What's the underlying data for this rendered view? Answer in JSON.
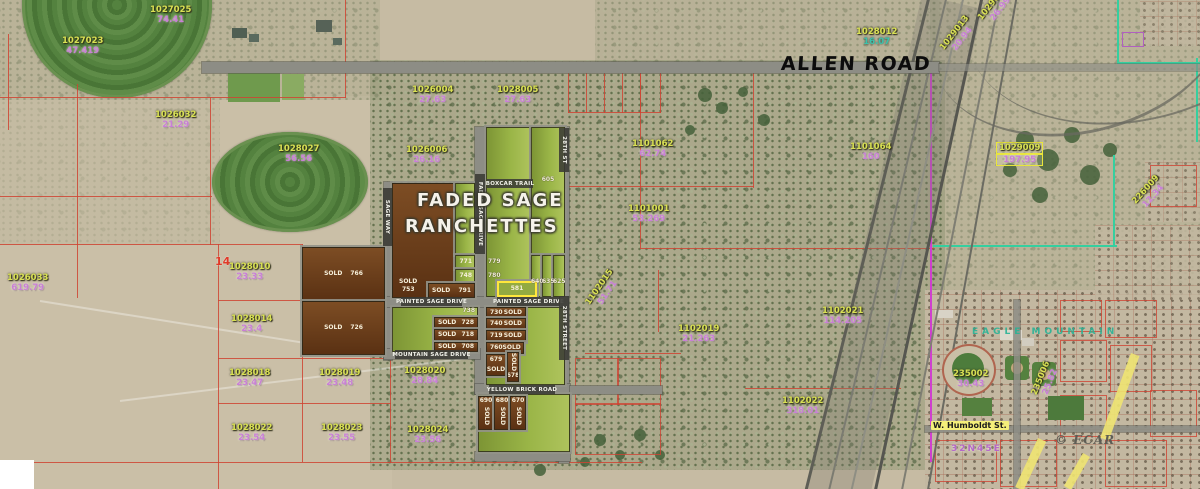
{
  "map": {
    "big_labels": {
      "allen_road": "ALLEN ROAD",
      "subdivision_line1": "FADED SAGE",
      "subdivision_line2": "RANCHETTES",
      "eagle_mountain": "EAGLE MOUNTAIN",
      "township": "32N45E",
      "humboldt_street": "W. Humboldt St.",
      "watermark": "© ECAR"
    },
    "streets": [
      {
        "t": "BOXCAR TRAIL",
        "x": 487,
        "y": 179,
        "w": 46,
        "h": 9,
        "v": 0
      },
      {
        "t": "PAINTED SAGE DRIVE",
        "x": 401,
        "y": 297,
        "w": 61,
        "h": 9,
        "v": 0
      },
      {
        "t": "PAINTED SAGE DRIVE",
        "x": 497,
        "y": 297,
        "w": 63,
        "h": 9,
        "v": 0
      },
      {
        "t": "MOUNTAIN SAGE DRIVE",
        "x": 395,
        "y": 350,
        "w": 73,
        "h": 9,
        "v": 0
      },
      {
        "t": "YELLOW BRICK ROAD",
        "x": 489,
        "y": 385,
        "w": 66,
        "h": 9,
        "v": 0
      },
      {
        "t": "28TH ST",
        "x": 559,
        "y": 128,
        "w": 10,
        "h": 44,
        "v": 1
      },
      {
        "t": "28TH STREET",
        "x": 559,
        "y": 296,
        "w": 10,
        "h": 64,
        "v": 1
      },
      {
        "t": "FADED SAGE DRIVE",
        "x": 475,
        "y": 174,
        "w": 10,
        "h": 80,
        "v": 1
      },
      {
        "t": "SAGE WAY",
        "x": 383,
        "y": 188,
        "w": 9,
        "h": 58,
        "v": 1
      }
    ],
    "parcels": [
      {
        "id": "1027023",
        "area": "47.419",
        "x": 62,
        "y": 36
      },
      {
        "id": "1027025",
        "area": "74.41",
        "x": 150,
        "y": 5
      },
      {
        "id": "1026032",
        "area": "21.29",
        "x": 155,
        "y": 110
      },
      {
        "id": "1028027",
        "area": "56.56",
        "x": 278,
        "y": 144
      },
      {
        "id": "1026004",
        "area": "27.63",
        "x": 412,
        "y": 85
      },
      {
        "id": "1028005",
        "area": "27.63",
        "x": 497,
        "y": 85
      },
      {
        "id": "1026006",
        "area": "26.16",
        "x": 406,
        "y": 145
      },
      {
        "id": "1028012",
        "area": "16.07",
        "x": 856,
        "y": 27,
        "style": "teal"
      },
      {
        "id": "1029013",
        "area": "20.94",
        "x": 938,
        "y": 26,
        "rot": -52
      },
      {
        "id": "1029012",
        "area": "26.99",
        "x": 976,
        "y": -4,
        "rot": -52
      },
      {
        "id": "1101062",
        "area": "62.74",
        "x": 632,
        "y": 139
      },
      {
        "id": "1101064",
        "area": "160",
        "x": 850,
        "y": 142
      },
      {
        "id": "1101001",
        "area": "53.269",
        "x": 628,
        "y": 204
      },
      {
        "id": "1029009",
        "area": "197.95",
        "x": 996,
        "y": 142,
        "style": "boxed"
      },
      {
        "id": "226009",
        "area": "12.34",
        "x": 1132,
        "y": 183,
        "rot": -48
      },
      {
        "id": "1102015",
        "area": "51.71",
        "x": 583,
        "y": 280,
        "rot": -55
      },
      {
        "id": "1102019",
        "area": "21.263",
        "x": 678,
        "y": 324
      },
      {
        "id": "1102021",
        "area": "114.205",
        "x": 822,
        "y": 306
      },
      {
        "id": "1102022",
        "area": "318.01",
        "x": 782,
        "y": 396
      },
      {
        "id": "1028020",
        "area": "28.84",
        "x": 404,
        "y": 366
      },
      {
        "id": "1026033",
        "area": "619.79",
        "x": 7,
        "y": 273
      },
      {
        "id": "14",
        "area": "",
        "x": 215,
        "y": 255,
        "style": "red"
      },
      {
        "id": "1028010",
        "area": "23.33",
        "x": 229,
        "y": 262
      },
      {
        "id": "1028014",
        "area": "23.4",
        "x": 231,
        "y": 314
      },
      {
        "id": "1028018",
        "area": "23.47",
        "x": 229,
        "y": 368
      },
      {
        "id": "1028019",
        "area": "23.48",
        "x": 319,
        "y": 368
      },
      {
        "id": "1028022",
        "area": "23.54",
        "x": 231,
        "y": 423
      },
      {
        "id": "1028023",
        "area": "23.55",
        "x": 321,
        "y": 423
      },
      {
        "id": "1028024",
        "area": "23.56",
        "x": 407,
        "y": 425
      },
      {
        "id": "235002",
        "area": "30.43",
        "x": 953,
        "y": 369
      },
      {
        "id": "235006",
        "area": "25.82",
        "x": 1028,
        "y": 370,
        "rot": -68
      }
    ],
    "lots": [
      {
        "x": 392,
        "y": 183,
        "w": 63,
        "h": 115,
        "c": "b",
        "t1": "SOLD",
        "t2": "753",
        "a": "bl"
      },
      {
        "x": 455,
        "y": 183,
        "w": 20,
        "h": 72,
        "c": "g"
      },
      {
        "x": 455,
        "y": 255,
        "w": 20,
        "h": 14,
        "c": "g",
        "t1": "771",
        "a": "r"
      },
      {
        "x": 455,
        "y": 269,
        "w": 20,
        "h": 14,
        "c": "g",
        "t1": "748",
        "a": "r"
      },
      {
        "x": 428,
        "y": 283,
        "w": 47,
        "h": 15,
        "c": "b",
        "t1": "SOLD",
        "t2": "791",
        "a": "h"
      },
      {
        "x": 486,
        "y": 127,
        "w": 45,
        "h": 170,
        "c": "g"
      },
      {
        "x": 531,
        "y": 127,
        "w": 34,
        "h": 128,
        "c": "g"
      },
      {
        "x": 531,
        "y": 255,
        "w": 11,
        "h": 42,
        "c": "g"
      },
      {
        "x": 542,
        "y": 255,
        "w": 11,
        "h": 42,
        "c": "g"
      },
      {
        "x": 553,
        "y": 255,
        "w": 12,
        "h": 42,
        "c": "g"
      },
      {
        "x": 497,
        "y": 281,
        "w": 40,
        "h": 16,
        "c": "y",
        "t1": "581",
        "a": "c"
      },
      {
        "x": 302,
        "y": 247,
        "w": 83,
        "h": 54,
        "c": "b",
        "t1": "SOLD",
        "t2": "766",
        "a": "hc"
      },
      {
        "x": 302,
        "y": 301,
        "w": 83,
        "h": 54,
        "c": "b",
        "t1": "SOLD",
        "t2": "726",
        "a": "hc"
      },
      {
        "x": 392,
        "y": 307,
        "w": 86,
        "h": 45,
        "c": "g"
      },
      {
        "x": 434,
        "y": 317,
        "w": 44,
        "h": 12,
        "c": "b",
        "t1": "SOLD",
        "t2": "728",
        "a": "h"
      },
      {
        "x": 434,
        "y": 329,
        "w": 44,
        "h": 12,
        "c": "b",
        "t1": "SOLD",
        "t2": "718",
        "a": "h"
      },
      {
        "x": 434,
        "y": 342,
        "w": 44,
        "h": 10,
        "c": "b",
        "t1": "SOLD",
        "t2": "708",
        "a": "h"
      },
      {
        "x": 486,
        "y": 307,
        "w": 79,
        "h": 78,
        "c": "g"
      },
      {
        "x": 486,
        "y": 307,
        "w": 40,
        "h": 11,
        "c": "b",
        "t1": "730",
        "t2": "SOLD",
        "a": "h"
      },
      {
        "x": 486,
        "y": 318,
        "w": 40,
        "h": 12,
        "c": "b",
        "t1": "740",
        "t2": "SOLD",
        "a": "h"
      },
      {
        "x": 486,
        "y": 330,
        "w": 40,
        "h": 12,
        "c": "b",
        "t1": "719",
        "t2": "SOLD",
        "a": "h"
      },
      {
        "x": 486,
        "y": 342,
        "w": 38,
        "h": 12,
        "c": "b",
        "t1": "760",
        "t2": "SOLD",
        "a": "h"
      },
      {
        "x": 486,
        "y": 354,
        "w": 20,
        "h": 22,
        "c": "b",
        "t1": "679",
        "t2": "SOLD",
        "a": "vs"
      },
      {
        "x": 507,
        "y": 352,
        "w": 12,
        "h": 30,
        "c": "b",
        "t1": "SOLD",
        "t2": "678",
        "a": "v2"
      },
      {
        "x": 478,
        "y": 394,
        "w": 92,
        "h": 58,
        "c": "g"
      },
      {
        "x": 478,
        "y": 396,
        "w": 16,
        "h": 34,
        "c": "b",
        "t1": "690",
        "t2": "SOLD",
        "a": "nv"
      },
      {
        "x": 494,
        "y": 396,
        "w": 16,
        "h": 34,
        "c": "b",
        "t1": "680",
        "t2": "SOLD",
        "a": "nv"
      },
      {
        "x": 510,
        "y": 396,
        "w": 16,
        "h": 34,
        "c": "b",
        "t1": "670",
        "t2": "SOLD",
        "a": "nv"
      }
    ],
    "tags": [
      {
        "x": 488,
        "y": 259,
        "w": 20,
        "t": "779",
        "al": "left"
      },
      {
        "x": 488,
        "y": 273,
        "w": 20,
        "t": "780",
        "al": "left"
      },
      {
        "x": 531,
        "y": 177,
        "w": 34,
        "t": "605",
        "al": "center"
      },
      {
        "x": 531,
        "y": 279,
        "w": 11,
        "t": "640",
        "al": "center"
      },
      {
        "x": 542,
        "y": 279,
        "w": 11,
        "t": "635",
        "al": "center"
      },
      {
        "x": 553,
        "y": 279,
        "w": 12,
        "t": "625",
        "al": "center"
      },
      {
        "x": 448,
        "y": 308,
        "w": 27,
        "t": "738",
        "al": "right"
      }
    ]
  }
}
